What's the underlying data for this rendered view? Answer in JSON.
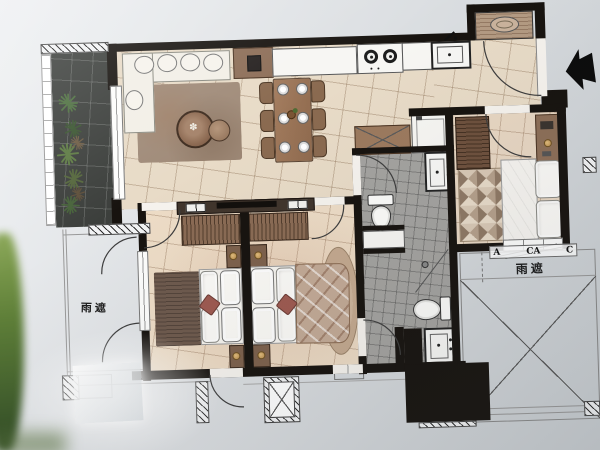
{
  "labels": {
    "rain_shade_left": "雨遮",
    "rain_shade_right": "雨遮",
    "dim_a": "A",
    "dim_ca": "CA",
    "dim_c": "C"
  },
  "icons": {
    "entry_arrow": "solid-left-arrow",
    "balcony_plants": "star-burst-plant-clusters",
    "door_swings": "quarter-circle-arc",
    "structure_hatch": "diagonal-hatch-blocks"
  },
  "colors": {
    "paper": "#d9dcdf",
    "wall": "#17130f",
    "floor_living": "#e8dbc7",
    "floor_bedroom": "#eddcc6",
    "floor_bedroom2": "#e8d7c3",
    "floor_bath": "#a4a3a0",
    "balcony_tile": "#3c3f3c",
    "wood": "#96715a",
    "wood_dark": "#6d5140",
    "accent_pillow": "#9e5a50",
    "plant_green": "#4a6b3a",
    "leaf_green": "#6a8f3f",
    "white_furniture": "#f7f6f3"
  }
}
